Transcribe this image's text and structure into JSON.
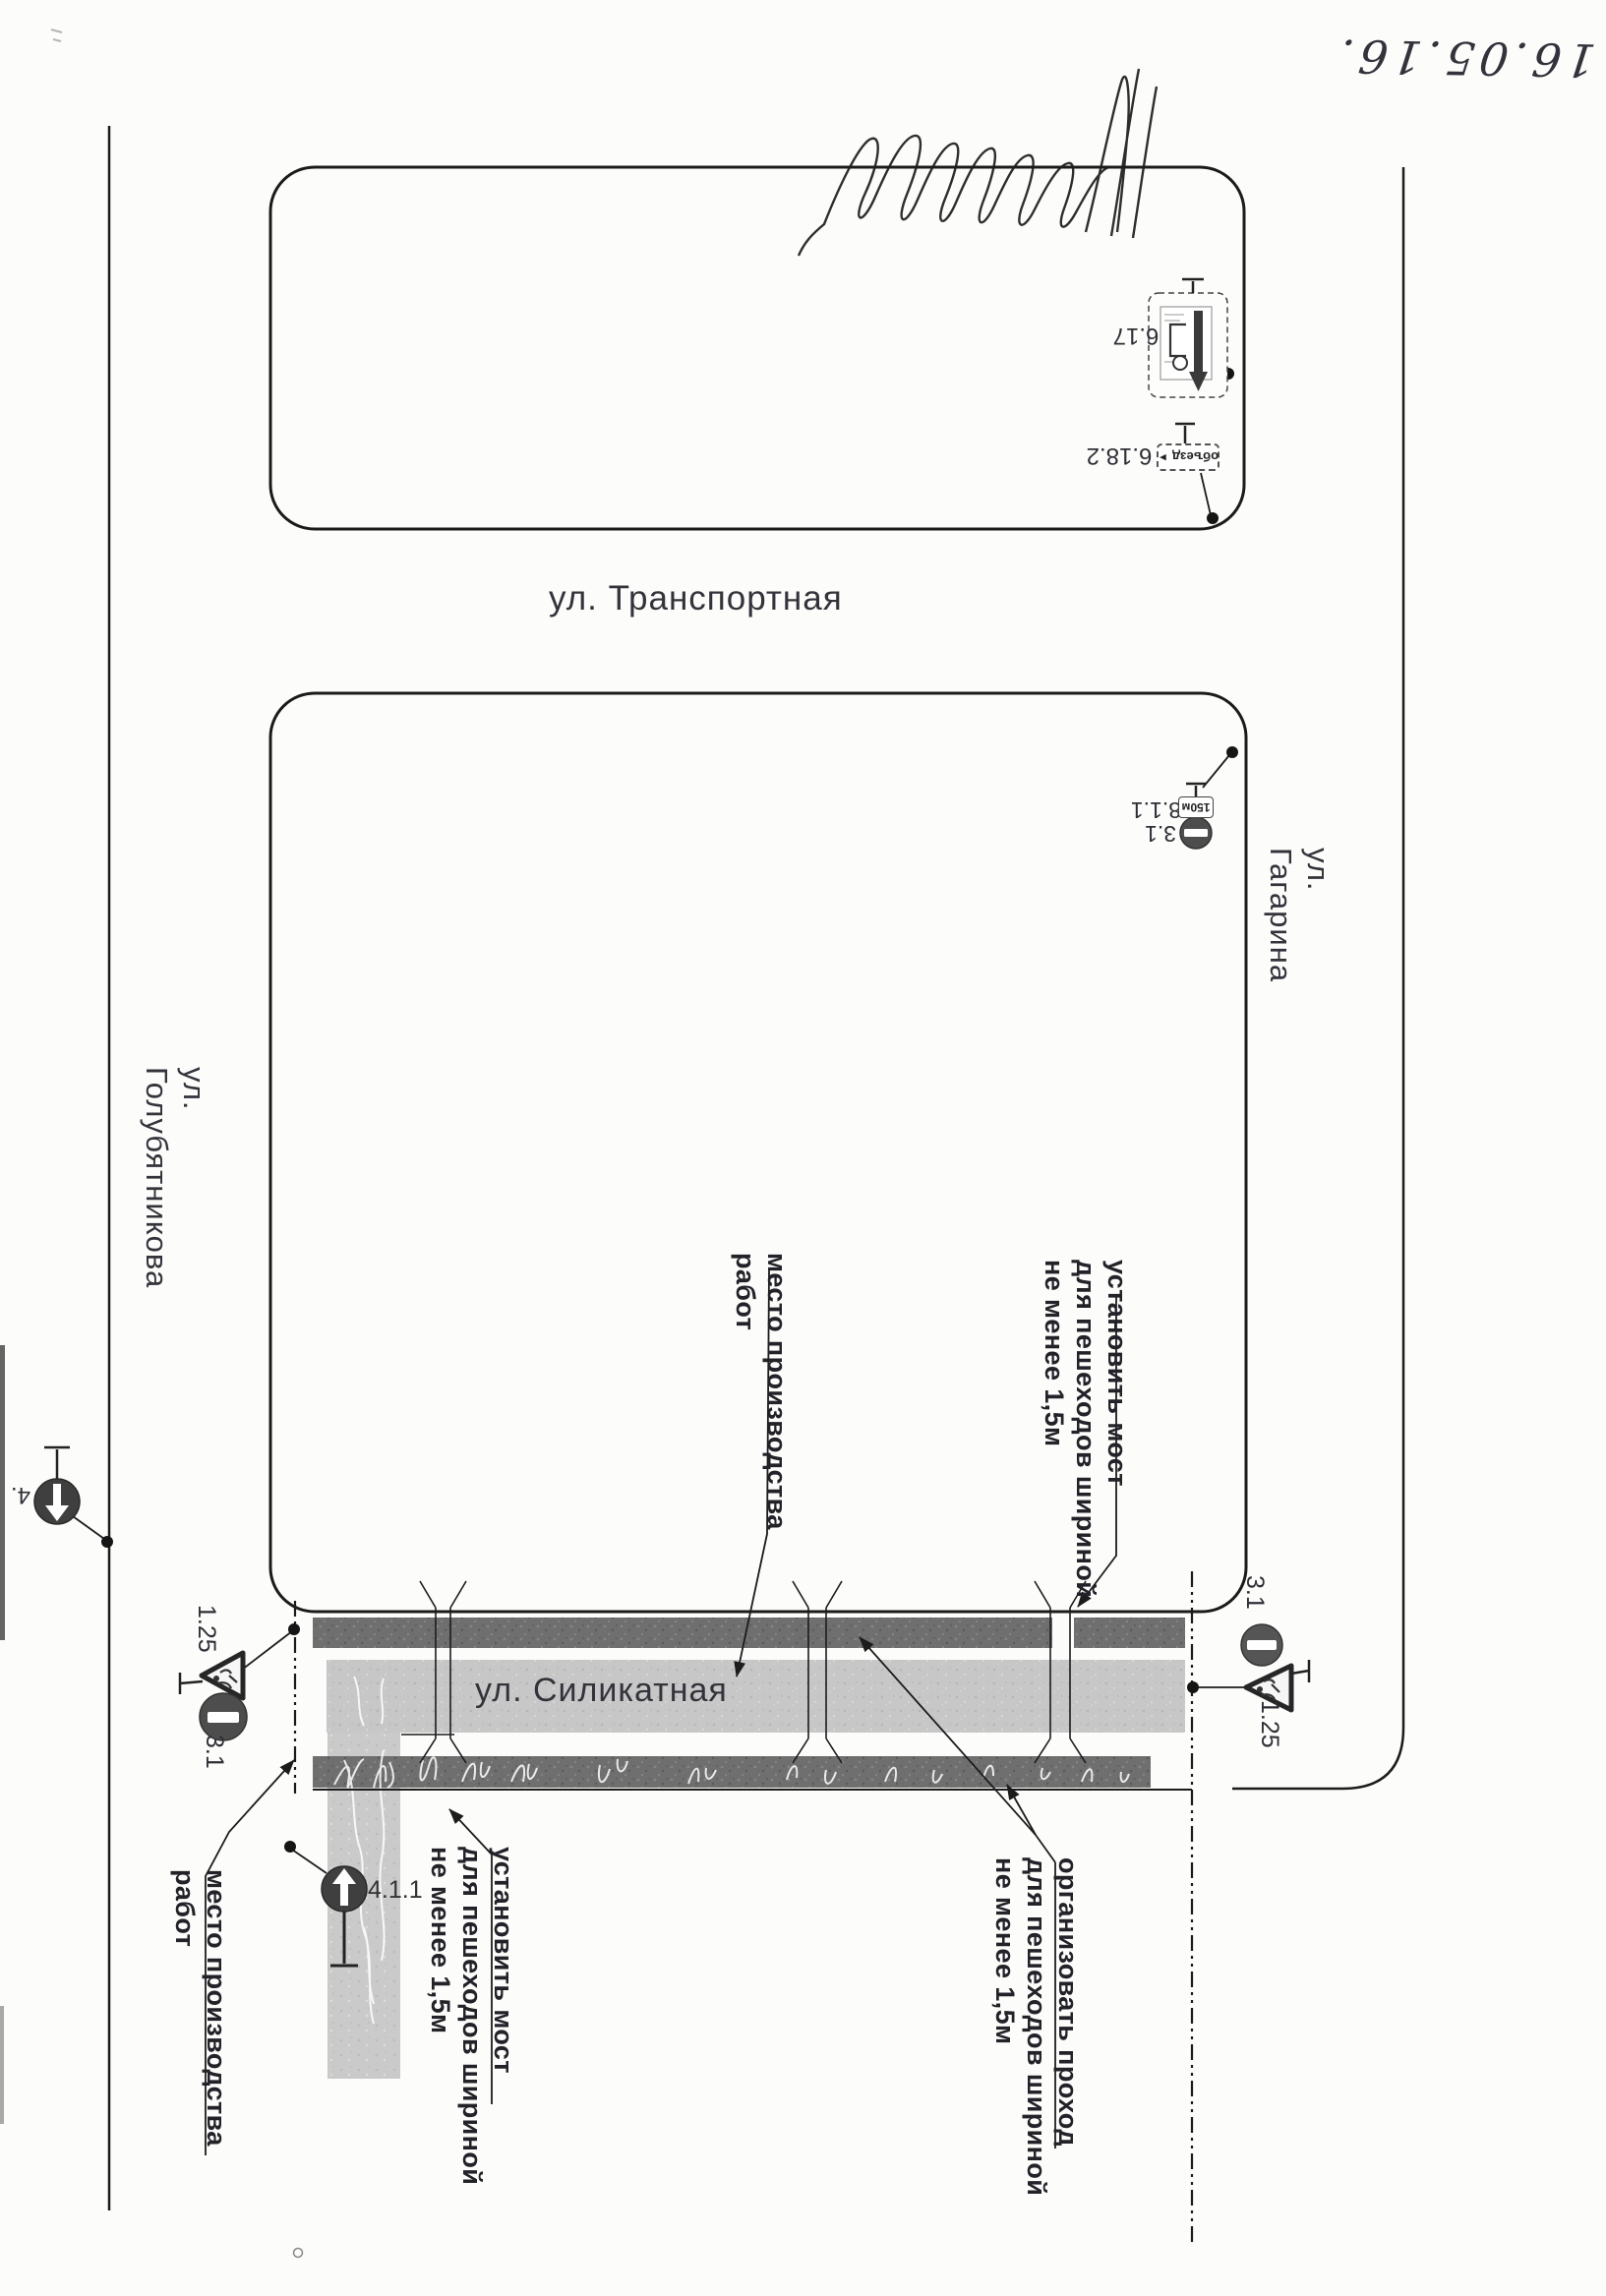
{
  "document": {
    "handwritten_date": "16.05.16."
  },
  "streets": {
    "transportnaya": "ул. Транспортная",
    "gagarina": "ул. Гагарина",
    "golubyatnikova": "ул. Голубятникова",
    "silikatnaya": "ул. Силикатная"
  },
  "annotations": {
    "work_site_center": "место производства\nработ",
    "install_bridge_right": "установить мост\nдля пешеходов шириной\nне менее 1,5м",
    "organize_passage": "организовать проход\nдля пешеходов шириной\nне менее 1,5м",
    "install_bridge_bottom": "установить мост\nдля пешеходов шириной\nне менее 1,5м",
    "work_site_bottom": "место производства\nработ"
  },
  "signs": {
    "detour_scheme": {
      "code": "6.17"
    },
    "detour_direction": {
      "code": "6.18.2",
      "plate_text": "объезд",
      "arrow_glyph": "►"
    },
    "no_entry_with_plate": {
      "code": "3.1"
    },
    "distance_plate": {
      "code": "8.1.1",
      "plate_text": "150м"
    },
    "ahead_only_left": {
      "code": "4."
    },
    "roadworks_left": {
      "code": "1.25"
    },
    "no_entry_left": {
      "code": "3.1"
    },
    "no_entry_right": {
      "code": "3.1"
    },
    "roadworks_right": {
      "code": "1.25"
    },
    "ahead_only_side_street": {
      "code": "4.1.1"
    }
  }
}
